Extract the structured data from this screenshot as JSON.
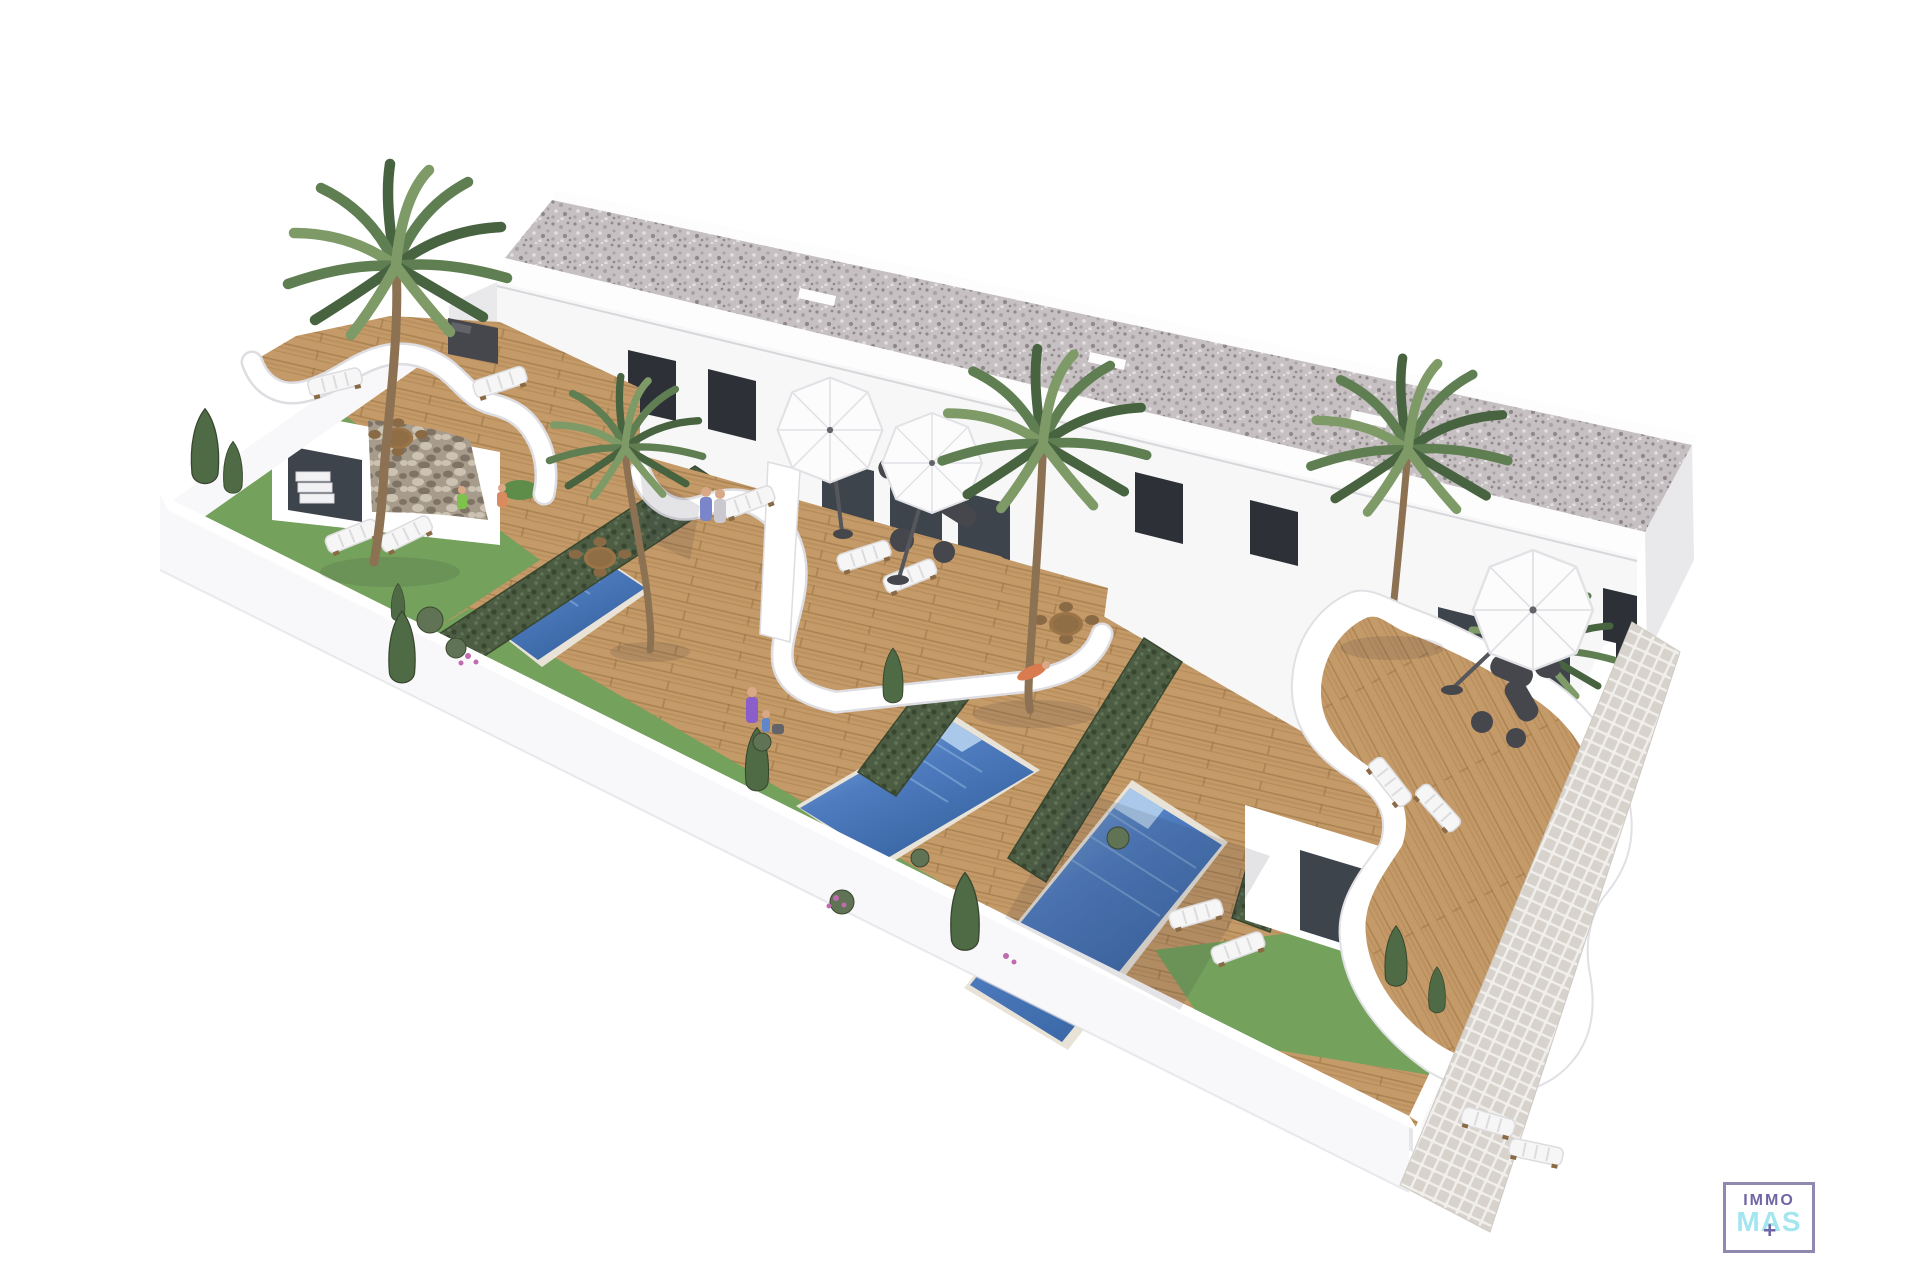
{
  "page": {
    "background": "#ffffff",
    "description": "Aerial 3D architectural rendering of a row of modern white townhouses with gravel flat roof, dark windows, curved white terraces, wooden sun decks, three private pools, green hedges, palm trees, sun loungers, parasols, a white perimeter wall and an exterior tiled walkway"
  },
  "logo": {
    "line1": "IMMO",
    "line2": "MAS",
    "plus_glyph": "+"
  },
  "colors": {
    "page_bg": "#ffffff",
    "roof_base": "#c6c0c2",
    "roof_speck_dark": "#8f888b",
    "roof_speck_mid": "#a9a2a5",
    "roof_speck_light": "#e3dfe0",
    "parapet_white": "#fdfdfd",
    "facade_white": "#f7f7f8",
    "end_wall": "#e9e9ec",
    "window_dark": "#2d3137",
    "glass_mid": "#3e444c",
    "window_frame": "#c9c9cd",
    "ground_wood": "#c59a69",
    "wood_stripe": "#aa8050",
    "wood_line": "#94703f",
    "lawn_green": "#74a15b",
    "lawn_dark": "#5e8c49",
    "pool_light": "#90b5e0",
    "pool_mid": "#4e7cbf",
    "pool_deep": "#35619e",
    "pool_step": "#aac8ea",
    "coping": "#e9e3d7",
    "hedge_green": "#4c5d44",
    "hedge_dark": "#39472f",
    "hedge_light": "#607455",
    "palm_dark": "#47633f",
    "palm_mid": "#5f7e52",
    "palm_light": "#7d9a67",
    "cypress": "#4e6b45",
    "trunk_brown": "#8c7253",
    "stone_base": "#a79b8b",
    "stone_dark": "#7e7365",
    "stone_light": "#cbc2b2",
    "tile_base": "#f1efec",
    "tile_square": "#d7d2cb",
    "wall_white": "#ffffff",
    "wall_outer": "#f8f8fa",
    "wall_inner_shade": "#e6e6ea",
    "furn_dark": "#46474c",
    "furn_mid": "#63646a",
    "furn_table": "#9a7347",
    "chair_wood": "#8a6a44",
    "umbrella_white": "#fcfcfd",
    "umbrella_shade": "#e2e2e6",
    "lounger_white": "#f6f6f6",
    "lounger_shade": "#dcdcdf",
    "shadow": "rgba(45,48,60,0.13)",
    "skin": "#d9a886",
    "logo_border": "#8d89b0",
    "logo_purple": "#6f66a5",
    "logo_cyan": "#a3e6f0"
  },
  "scene": {
    "type": "architectural-render",
    "counts": {
      "townhouse_units": 4,
      "pools": 3,
      "parasols": 3,
      "palm_trees": 5,
      "sun_loungers": 12,
      "dining_sets": 3,
      "lounge_sets": 2,
      "cypress_trees": 9,
      "hedge_rows": 4
    },
    "features": [
      "gravel flat roof",
      "white render facade",
      "dark glazed windows and doors",
      "stone feature walls",
      "curved white terrace parapets",
      "timber decking",
      "private swimming pools",
      "privacy hedges",
      "lawn gardens",
      "white boundary wall",
      "exterior tiled walkway"
    ]
  }
}
